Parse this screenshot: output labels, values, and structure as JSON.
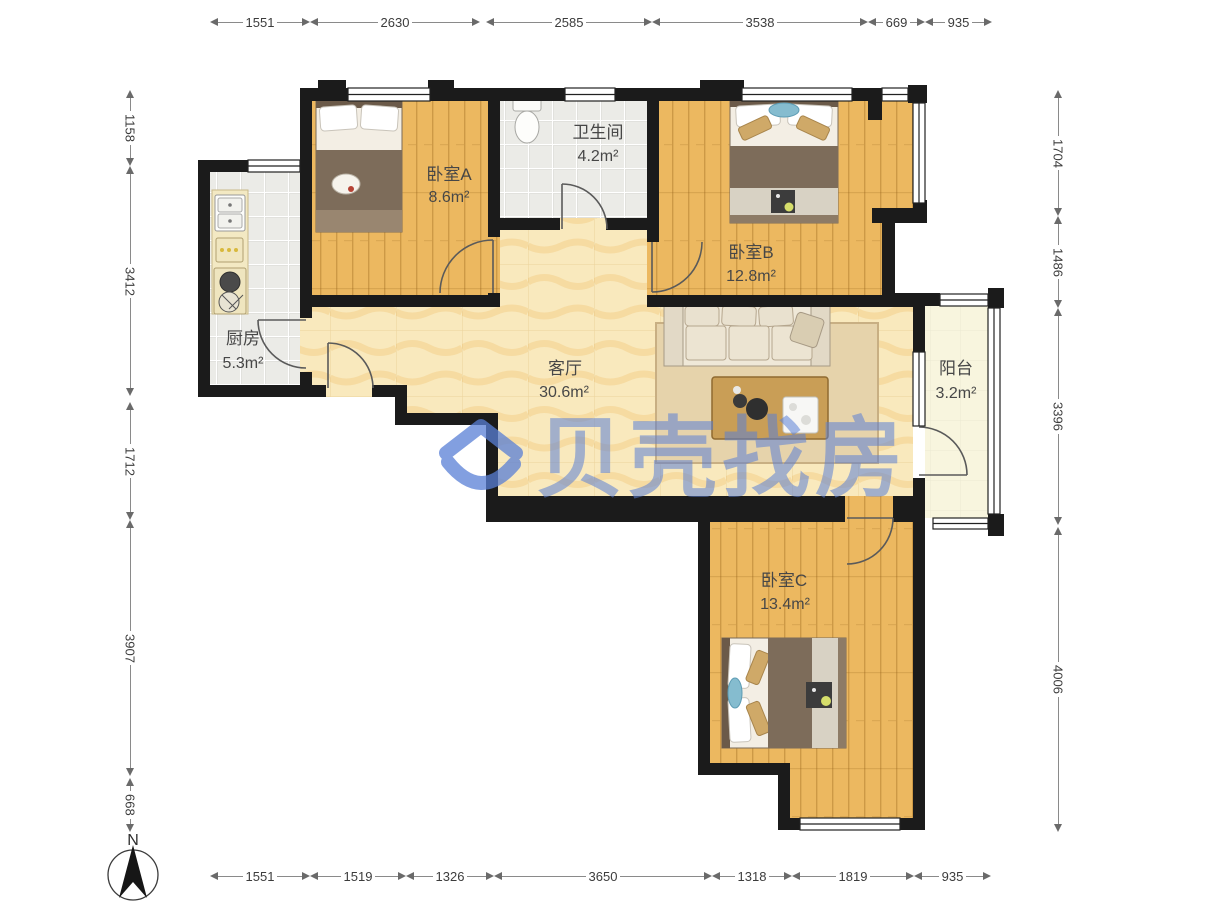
{
  "watermark": {
    "brand": "贝壳找房"
  },
  "compass": {
    "north": "N"
  },
  "rooms": [
    {
      "name": "卧室A",
      "area": "8.6m²"
    },
    {
      "name": "卫生间",
      "area": "4.2m²"
    },
    {
      "name": "卧室B",
      "area": "12.8m²"
    },
    {
      "name": "厨房",
      "area": "5.3m²"
    },
    {
      "name": "客厅",
      "area": "30.6m²"
    },
    {
      "name": "阳台",
      "area": "3.2m²"
    },
    {
      "name": "卧室C",
      "area": "13.4m²"
    }
  ],
  "dimensions_mm": {
    "top": [
      "1551",
      "2630",
      "2585",
      "3538",
      "669",
      "935"
    ],
    "bottom": [
      "1551",
      "1519",
      "1326",
      "3650",
      "1318",
      "1819",
      "935"
    ],
    "left": [
      "1158",
      "3412",
      "1712",
      "3907",
      "668"
    ],
    "right": [
      "1704",
      "1486",
      "3396",
      "4006"
    ]
  },
  "colors": {
    "wall": "#1b1b1b",
    "wood_floor": "#ecb860",
    "living_floor": "#f9e9bd",
    "tile_floor": "#ececе8",
    "balcony_floor": "#f8f5de",
    "brand_blue": "#597fd6"
  }
}
